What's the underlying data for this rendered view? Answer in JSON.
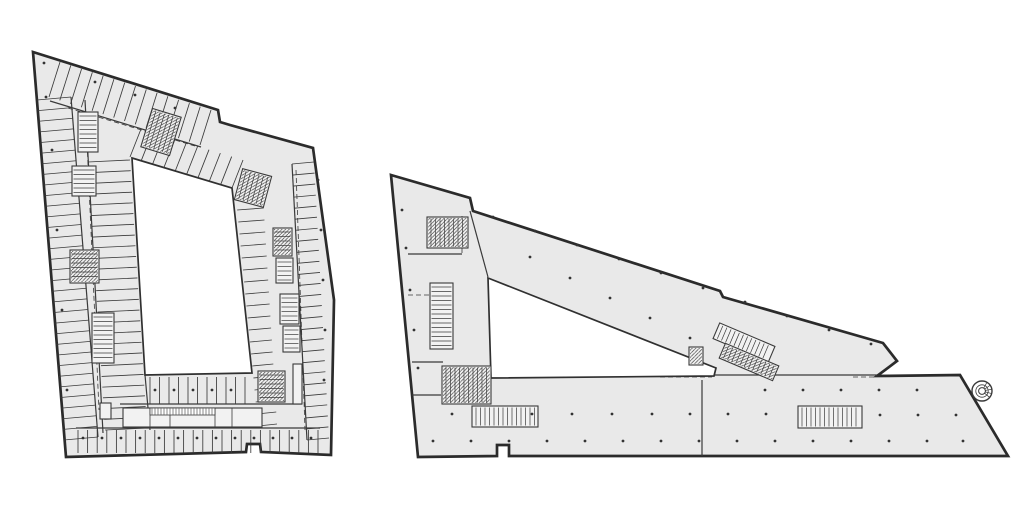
{
  "meta": {
    "canvas_w": 1024,
    "canvas_h": 505,
    "background": "#ffffff",
    "drawing_kind": "architectural-floor-plans",
    "icons": {
      "spiral_stair": "spiral-stair-icon"
    }
  },
  "style": {
    "plan_fill": "#e9e9e9",
    "courtyard_fill": "#ffffff",
    "wall_color": "#2b2b2b",
    "line_color": "#3a3a3a",
    "core_fill": "#f2f2f2",
    "dot_color": "#333333",
    "outer_width": 2.7,
    "mid_width": 1.2,
    "thin_width": 0.85,
    "dot_radius": 1.4
  },
  "left_building": {
    "outline": [
      [
        33,
        52
      ],
      [
        218,
        110
      ],
      [
        220,
        122
      ],
      [
        230,
        125
      ],
      [
        313,
        148
      ],
      [
        334,
        300
      ],
      [
        331,
        455
      ],
      [
        261,
        452
      ],
      [
        260,
        444
      ],
      [
        247,
        444
      ],
      [
        246,
        452
      ],
      [
        66,
        457
      ]
    ],
    "courtyard": [
      [
        132,
        158
      ],
      [
        232,
        188
      ],
      [
        252,
        373
      ],
      [
        145,
        375
      ]
    ],
    "combs": [
      {
        "a1": [
          37,
          100
        ],
        "a2": [
          71,
          97
        ],
        "b1": [
          64,
          440
        ],
        "b2": [
          98,
          437
        ],
        "n": 33
      },
      {
        "a1": [
          88,
          162
        ],
        "a2": [
          130,
          160
        ],
        "b1": [
          105,
          430
        ],
        "b2": [
          147,
          428
        ],
        "n": 26
      },
      {
        "a1": [
          60,
          62
        ],
        "a2": [
          49,
          97
        ],
        "b1": [
          211,
          110
        ],
        "b2": [
          200,
          145
        ],
        "n": 15
      },
      {
        "a1": [
          141,
          129
        ],
        "a2": [
          130,
          157
        ],
        "b1": [
          243,
          160
        ],
        "b2": [
          232,
          188
        ],
        "n": 10
      },
      {
        "a1": [
          314,
          162
        ],
        "a2": [
          292,
          164
        ],
        "b1": [
          329,
          438
        ],
        "b2": [
          307,
          440
        ],
        "n": 26
      },
      {
        "a1": [
          263,
          196
        ],
        "a2": [
          236,
          198
        ],
        "b1": [
          277,
          424
        ],
        "b2": [
          258,
          426
        ],
        "n": 20
      },
      {
        "a1": [
          150,
          377
        ],
        "a2": [
          150,
          404
        ],
        "b1": [
          245,
          377
        ],
        "b2": [
          245,
          404
        ],
        "n": 11
      },
      {
        "a1": [
          78,
          430
        ],
        "a2": [
          78,
          453
        ],
        "b1": [
          318,
          430
        ],
        "b2": [
          318,
          453
        ],
        "n": 26
      }
    ],
    "lines": [
      [
        [
          71,
          97
        ],
        [
          98,
          437
        ]
      ],
      [
        [
          85,
          100
        ],
        [
          103,
          433
        ]
      ],
      [
        [
          50,
          101
        ],
        [
          201,
          147
        ]
      ],
      [
        [
          292,
          164
        ],
        [
          307,
          440
        ]
      ],
      [
        [
          120,
          404
        ],
        [
          302,
          404
        ]
      ],
      [
        [
          76,
          428
        ],
        [
          320,
          428
        ]
      ],
      [
        [
          145,
          375
        ],
        [
          150,
          430
        ]
      ]
    ],
    "dashed": [
      [
        [
          68,
          108
        ],
        [
          195,
          146
        ]
      ],
      [
        [
          86,
          120
        ],
        [
          99,
          410
        ]
      ],
      [
        [
          296,
          170
        ],
        [
          305,
          430
        ]
      ]
    ],
    "cores": [
      {
        "x": 146,
        "y": 112,
        "w": 30,
        "h": 40,
        "rot": 17,
        "hatch": true,
        "ticks": "v"
      },
      {
        "x": 238,
        "y": 172,
        "w": 30,
        "h": 32,
        "rot": 15,
        "hatch": true,
        "ticks": "v"
      },
      {
        "x": 78,
        "y": 112,
        "w": 20,
        "h": 40,
        "ticks": "h"
      },
      {
        "x": 72,
        "y": 166,
        "w": 24,
        "h": 30,
        "ticks": "h"
      },
      {
        "x": 70,
        "y": 250,
        "w": 29,
        "h": 33,
        "hatch": true,
        "ticks": "h"
      },
      {
        "x": 92,
        "y": 313,
        "w": 22,
        "h": 50,
        "ticks": "h"
      },
      {
        "x": 273,
        "y": 228,
        "w": 19,
        "h": 28,
        "hatch": true,
        "ticks": "h"
      },
      {
        "x": 276,
        "y": 258,
        "w": 17,
        "h": 25,
        "ticks": "h"
      },
      {
        "x": 280,
        "y": 294,
        "w": 19,
        "h": 30,
        "ticks": "h"
      },
      {
        "x": 283,
        "y": 326,
        "w": 17,
        "h": 26,
        "ticks": "h"
      },
      {
        "x": 258,
        "y": 371,
        "w": 27,
        "h": 31,
        "hatch": true,
        "ticks": "h"
      },
      {
        "x": 293,
        "y": 364,
        "w": 9,
        "h": 40
      },
      {
        "x": 100,
        "y": 403,
        "w": 11,
        "h": 16
      }
    ],
    "entrance_cluster": {
      "x": 123,
      "y": 408,
      "w": 139,
      "h": 19,
      "dividers": [
        150,
        170,
        215,
        232
      ],
      "dense": {
        "x": 150,
        "y": 408,
        "w": 65,
        "h": 7
      }
    },
    "dots": [
      [
        44,
        63
      ],
      [
        46,
        97
      ],
      [
        95,
        82
      ],
      [
        135,
        95
      ],
      [
        175,
        108
      ],
      [
        52,
        150
      ],
      [
        57,
        230
      ],
      [
        62,
        310
      ],
      [
        67,
        390
      ],
      [
        318,
        180
      ],
      [
        321,
        230
      ],
      [
        323,
        280
      ],
      [
        325,
        330
      ],
      [
        324,
        380
      ],
      [
        155,
        390
      ],
      [
        174,
        390
      ],
      [
        193,
        390
      ],
      [
        212,
        390
      ],
      [
        231,
        390
      ],
      [
        83,
        438
      ],
      [
        102,
        438
      ],
      [
        121,
        438
      ],
      [
        140,
        438
      ],
      [
        159,
        438
      ],
      [
        178,
        438
      ],
      [
        197,
        438
      ],
      [
        216,
        438
      ],
      [
        235,
        438
      ],
      [
        254,
        438
      ],
      [
        273,
        438
      ],
      [
        292,
        438
      ],
      [
        311,
        438
      ]
    ]
  },
  "right_building": {
    "outline": [
      [
        391,
        175
      ],
      [
        470,
        198
      ],
      [
        473,
        211
      ],
      [
        720,
        291
      ],
      [
        723,
        297
      ],
      [
        883,
        343
      ],
      [
        897,
        361
      ],
      [
        877,
        376
      ],
      [
        960,
        375
      ],
      [
        1008,
        456
      ],
      [
        509,
        456
      ],
      [
        509,
        445
      ],
      [
        497,
        445
      ],
      [
        497,
        456
      ],
      [
        418,
        457
      ]
    ],
    "courtyard": [
      [
        488,
        278
      ],
      [
        716,
        368
      ],
      [
        714,
        376
      ],
      [
        491,
        378
      ]
    ],
    "combs": [],
    "lines": [
      [
        [
          470,
          211
        ],
        [
          488,
          277
        ]
      ],
      [
        [
          408,
          254
        ],
        [
          462,
          254
        ]
      ],
      [
        [
          412,
          362
        ],
        [
          443,
          362
        ]
      ],
      [
        [
          412,
          395
        ],
        [
          441,
          395
        ]
      ],
      [
        [
          714,
          375
        ],
        [
          877,
          375
        ]
      ],
      [
        [
          702,
          380
        ],
        [
          702,
          456
        ]
      ]
    ],
    "dashed": [
      [
        [
          462,
          216
        ],
        [
          462,
          253
        ]
      ],
      [
        [
          408,
          295
        ],
        [
          432,
          295
        ]
      ],
      [
        [
          853,
          377
        ],
        [
          877,
          377
        ]
      ],
      [
        [
          660,
          377
        ],
        [
          712,
          377
        ]
      ]
    ],
    "cores": [
      {
        "x": 427,
        "y": 217,
        "w": 41,
        "h": 31,
        "hatch": true,
        "ticks": "v"
      },
      {
        "x": 430,
        "y": 283,
        "w": 23,
        "h": 66,
        "ticks": "h"
      },
      {
        "x": 442,
        "y": 366,
        "w": 49,
        "h": 38,
        "hatch": true,
        "ticks": "v"
      },
      {
        "x": 689,
        "y": 347,
        "w": 14,
        "h": 18,
        "hatch": true
      },
      {
        "x": 714,
        "y": 334,
        "w": 60,
        "h": 17,
        "rot": 23,
        "ticks": "v"
      },
      {
        "x": 720,
        "y": 354,
        "w": 58,
        "h": 16,
        "rot": 23,
        "hatch": true,
        "ticks": "v"
      },
      {
        "x": 472,
        "y": 406,
        "w": 66,
        "h": 21,
        "ticks": "v"
      },
      {
        "x": 798,
        "y": 406,
        "w": 64,
        "h": 22,
        "ticks": "v"
      }
    ],
    "spiral": {
      "cx": 982,
      "cy": 391,
      "r": 10
    },
    "dots": [
      [
        493,
        217
      ],
      [
        535,
        231
      ],
      [
        577,
        245
      ],
      [
        619,
        259
      ],
      [
        661,
        273
      ],
      [
        703,
        288
      ],
      [
        745,
        302
      ],
      [
        787,
        316
      ],
      [
        829,
        330
      ],
      [
        871,
        344
      ],
      [
        530,
        257
      ],
      [
        570,
        278
      ],
      [
        610,
        298
      ],
      [
        650,
        318
      ],
      [
        690,
        338
      ],
      [
        402,
        210
      ],
      [
        406,
        248
      ],
      [
        410,
        290
      ],
      [
        414,
        330
      ],
      [
        418,
        368
      ],
      [
        765,
        390
      ],
      [
        803,
        390
      ],
      [
        841,
        390
      ],
      [
        879,
        390
      ],
      [
        917,
        390
      ],
      [
        452,
        414
      ],
      [
        532,
        414
      ],
      [
        572,
        414
      ],
      [
        612,
        414
      ],
      [
        652,
        414
      ],
      [
        690,
        414
      ],
      [
        728,
        414
      ],
      [
        766,
        414
      ],
      [
        880,
        415
      ],
      [
        918,
        415
      ],
      [
        956,
        415
      ],
      [
        433,
        441
      ],
      [
        471,
        441
      ],
      [
        509,
        441
      ],
      [
        547,
        441
      ],
      [
        585,
        441
      ],
      [
        623,
        441
      ],
      [
        661,
        441
      ],
      [
        699,
        441
      ],
      [
        737,
        441
      ],
      [
        775,
        441
      ],
      [
        813,
        441
      ],
      [
        851,
        441
      ],
      [
        889,
        441
      ],
      [
        927,
        441
      ],
      [
        963,
        441
      ]
    ]
  }
}
